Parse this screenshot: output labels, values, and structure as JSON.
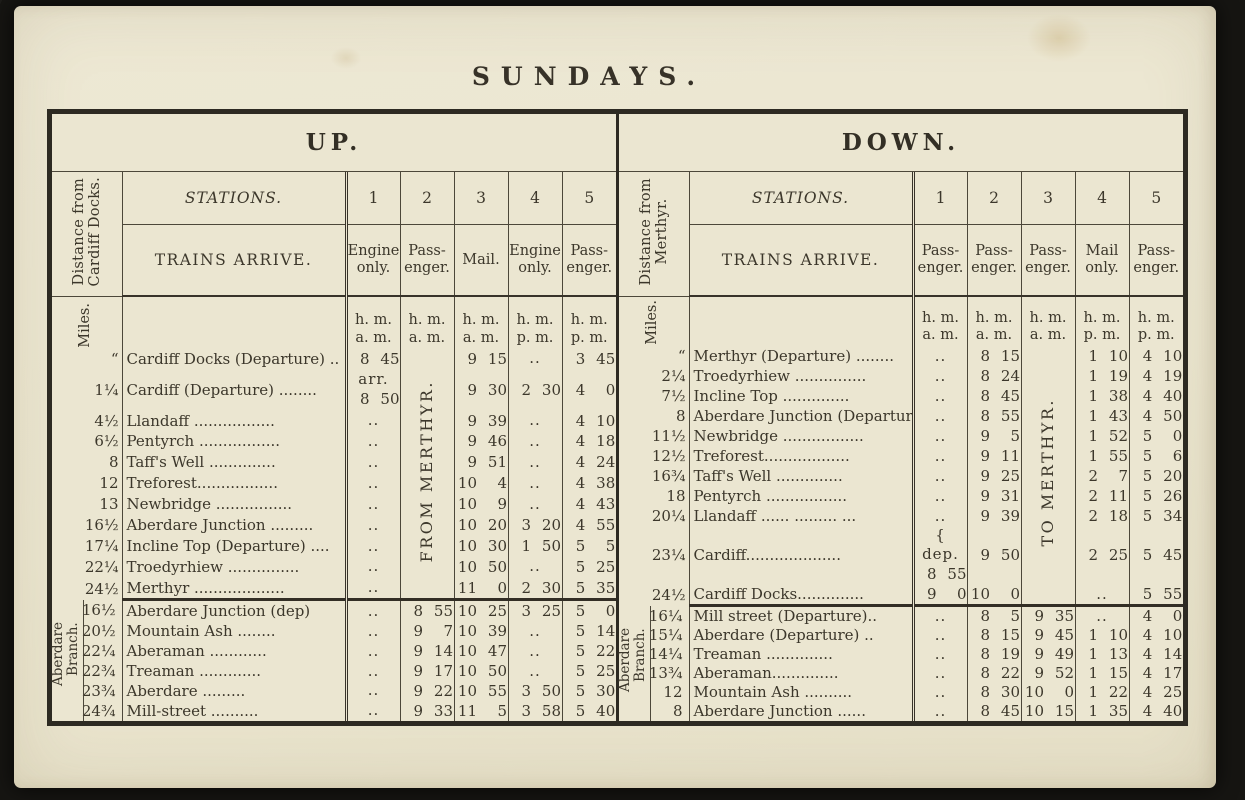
{
  "page": {
    "title": "SUNDAYS."
  },
  "up": {
    "title": "UP.",
    "side_label": "Distance from\nCardiff Docks.",
    "miles_label": "Miles.",
    "stations_header": "STATIONS.",
    "arrive_header": "TRAINS ARRIVE.",
    "col_numbers": [
      "1",
      "2",
      "3",
      "4",
      "5"
    ],
    "col_types": [
      "Engine\nonly.",
      "Pass-\nenger.",
      "Mail.",
      "Engine\nonly.",
      "Pass-\nenger."
    ],
    "time_units": [
      "h. m.\na. m.",
      "h. m.\na. m.",
      "h. m.\na. m.",
      "h. m.\np. m.",
      "h. m.\np. m."
    ],
    "vertical_note": {
      "col": 1,
      "text": "FROM MERTHYR."
    },
    "main_rows": [
      {
        "miles": "“",
        "station": "Cardiff Docks (Departure) ..",
        "times": [
          "8 45",
          null,
          "9 15",
          "..",
          "3 45"
        ]
      },
      {
        "miles": "1¼",
        "station": "Cardiff (Departure)  ........",
        "times": [
          "arr.\n8 50",
          null,
          "9 30",
          "2 30",
          "4 0"
        ]
      },
      {
        "miles": "4½",
        "station": "Llandaff .................",
        "times": [
          "..",
          null,
          "9 39",
          "..",
          "4 10"
        ]
      },
      {
        "miles": "6½",
        "station": "Pentyrch .................",
        "times": [
          "..",
          null,
          "9 46",
          "..",
          "4 18"
        ]
      },
      {
        "miles": "8",
        "station": "Taff's Well ..............",
        "times": [
          "..",
          null,
          "9 51",
          "..",
          "4 24"
        ]
      },
      {
        "miles": "12",
        "station": "Treforest.................",
        "times": [
          "..",
          null,
          "10 4",
          "..",
          "4 38"
        ]
      },
      {
        "miles": "13",
        "station": "Newbridge ................",
        "times": [
          "..",
          null,
          "10 9",
          "..",
          "4 43"
        ]
      },
      {
        "miles": "16½",
        "station": "Aberdare Junction .........",
        "times": [
          "..",
          null,
          "10 20",
          "3 20",
          "4 55"
        ]
      },
      {
        "miles": "17¼",
        "station": "Incline Top (Departure) ....",
        "times": [
          "..",
          null,
          "10 30",
          "1 50",
          "5 5"
        ]
      },
      {
        "miles": "22¼",
        "station": "Troedyrhiew ...............",
        "times": [
          "..",
          null,
          "10 50",
          "..",
          "5 25"
        ]
      },
      {
        "miles": "24½",
        "station": "Merthyr ...................",
        "times": [
          "..",
          null,
          "11 0",
          "2 30",
          "5 35"
        ]
      }
    ],
    "branch_label": "Aberdare\nBranch.",
    "branch_rows": [
      {
        "miles": "16½",
        "station": "Aberdare Junction (dep)",
        "times": [
          "..",
          "8 55",
          "10 25",
          "3 25",
          "5 0"
        ]
      },
      {
        "miles": "20½",
        "station": "Mountain Ash ........",
        "times": [
          "..",
          "9 7",
          "10 39",
          "..",
          "5 14"
        ]
      },
      {
        "miles": "22¼",
        "station": "Aberaman ............",
        "times": [
          "..",
          "9 14",
          "10 47",
          "..",
          "5 22"
        ]
      },
      {
        "miles": "22¾",
        "station": "Treaman .............",
        "times": [
          "..",
          "9 17",
          "10 50",
          "..",
          "5 25"
        ]
      },
      {
        "miles": "23¾",
        "station": "Aberdare   .........",
        "times": [
          "..",
          "9 22",
          "10 55",
          "3 50",
          "5 30"
        ]
      },
      {
        "miles": "24¾",
        "station": "Mill-street ..........",
        "times": [
          "..",
          "9 33",
          "11 5",
          "3 58",
          "5 40"
        ]
      }
    ]
  },
  "down": {
    "title": "DOWN.",
    "side_label": "Distance from\nMerthyr.",
    "miles_label": "Miles.",
    "stations_header": "STATIONS.",
    "arrive_header": "TRAINS ARRIVE.",
    "col_numbers": [
      "1",
      "2",
      "3",
      "4",
      "5"
    ],
    "col_types": [
      "Pass-\nenger.",
      "Pass-\nenger.",
      "Pass-\nenger.",
      "Mail\nonly.",
      "Pass-\nenger."
    ],
    "time_units": [
      "h. m.\na. m.",
      "h. m.\na. m.",
      "h. m.\na. m.",
      "h. m.\np. m.",
      "h. m.\np. m."
    ],
    "vertical_note": {
      "col": 2,
      "text": "TO MERTHYR."
    },
    "main_rows": [
      {
        "miles": "“",
        "station": "Merthyr (Departure)  ........",
        "times": [
          "..",
          "8 15",
          null,
          "1 10",
          "4 10"
        ]
      },
      {
        "miles": "2¼",
        "station": "Troedyrhiew ...............",
        "times": [
          "..",
          "8 24",
          null,
          "1 19",
          "4 19"
        ]
      },
      {
        "miles": "7½",
        "station": "Incline Top  ..............",
        "times": [
          "..",
          "8 45",
          null,
          "1 38",
          "4 40"
        ]
      },
      {
        "miles": "8",
        "station": "Aberdare Junction (Departure)",
        "times": [
          "..",
          "8 55",
          null,
          "1 43",
          "4 50"
        ]
      },
      {
        "miles": "11½",
        "station": "Newbridge .................",
        "times": [
          "..",
          "9 5",
          null,
          "1 52",
          "5 0"
        ]
      },
      {
        "miles": "12½",
        "station": "Treforest..................",
        "times": [
          "..",
          "9 11",
          null,
          "1 55",
          "5 6"
        ]
      },
      {
        "miles": "16¾",
        "station": "Taff's Well  ..............",
        "times": [
          "..",
          "9 25",
          null,
          "2 7",
          "5 20"
        ]
      },
      {
        "miles": "18",
        "station": "Pentyrch  .................",
        "times": [
          "..",
          "9 31",
          null,
          "2 11",
          "5 26"
        ]
      },
      {
        "miles": "20¼",
        "station": "Llandaff ...... ......... ...",
        "times": [
          "..",
          "9 39",
          null,
          "2 18",
          "5 34"
        ]
      },
      {
        "miles": "23¼",
        "station": "Cardiff....................",
        "times": [
          "{ dep.\n8 55",
          "9 50",
          null,
          "2 25",
          "5 45"
        ]
      },
      {
        "miles": "24½",
        "station": "Cardiff Docks..............",
        "times": [
          "9 0",
          "10 0",
          null,
          "..",
          "5 55"
        ]
      }
    ],
    "branch_label": "Aberdare\nBranch.",
    "branch_rows": [
      {
        "miles": "16¼",
        "station": "Mill street (Departure)..",
        "times": [
          "..",
          "8 5",
          "9 35",
          "..",
          "4 0"
        ]
      },
      {
        "miles": "15¼",
        "station": "Aberdare (Departure)  ..",
        "times": [
          "..",
          "8 15",
          "9 45",
          "1 10",
          "4 10"
        ]
      },
      {
        "miles": "14¼",
        "station": "Treaman ..............",
        "times": [
          "..",
          "8 19",
          "9 49",
          "1 13",
          "4 14"
        ]
      },
      {
        "miles": "13¾",
        "station": "Aberaman..............",
        "times": [
          "..",
          "8 22",
          "9 52",
          "1 15",
          "4 17"
        ]
      },
      {
        "miles": "12",
        "station": "Mountain Ash ..........",
        "times": [
          "..",
          "8 30",
          "10 0",
          "1 22",
          "4 25"
        ]
      },
      {
        "miles": "8",
        "station": "Aberdare Junction ......",
        "times": [
          "..",
          "8 45",
          "10 15",
          "1 35",
          "4 40"
        ]
      }
    ]
  }
}
